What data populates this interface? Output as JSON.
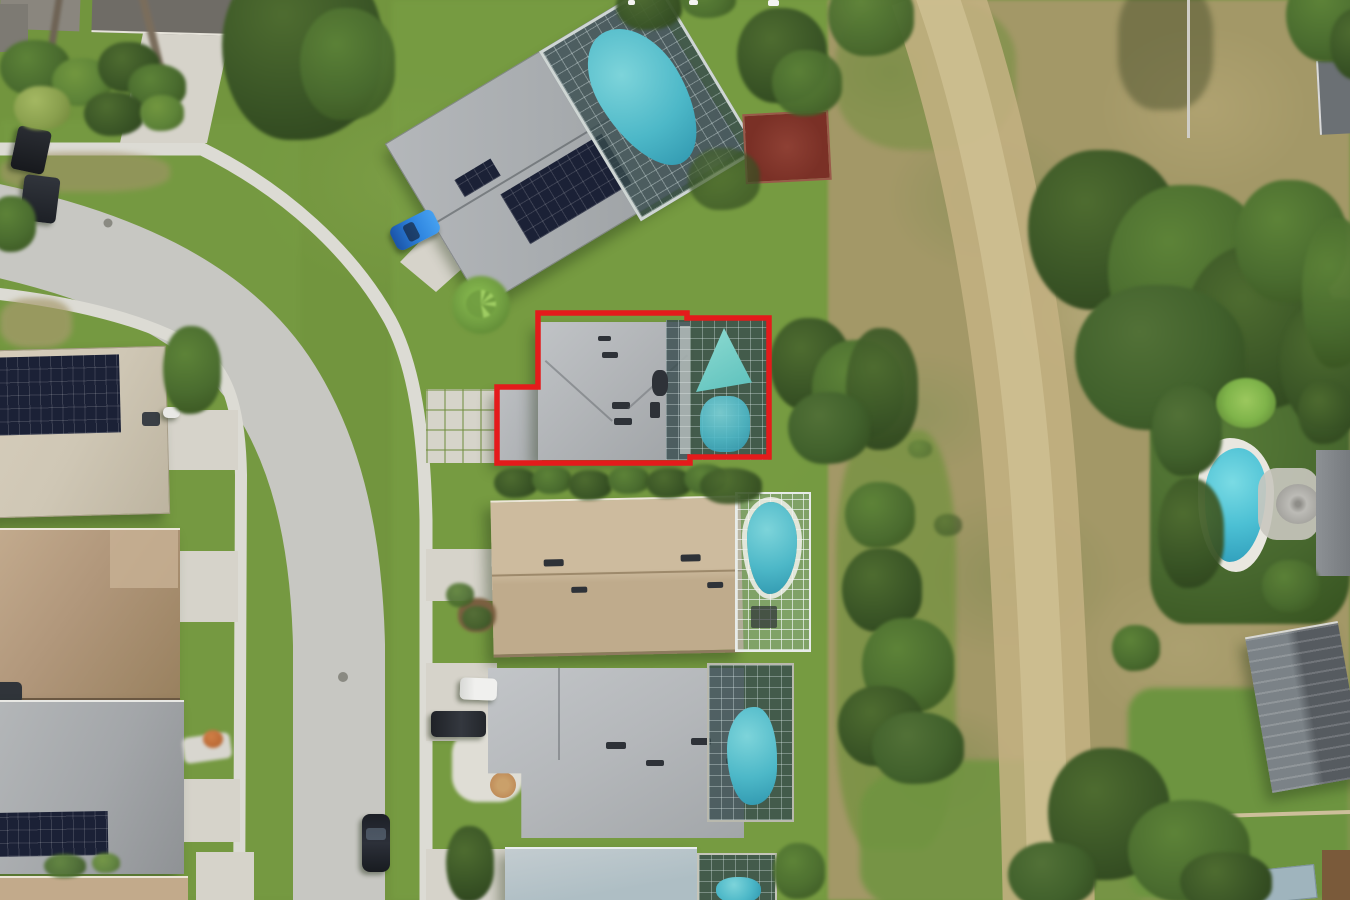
{
  "meta": {
    "description": "Aerial drone photograph of a suburban neighborhood; subject lot highlighted",
    "orientation": "overhead"
  },
  "annotation": {
    "type": "subject-property-boundary",
    "shape": "polygon",
    "color": "#e41b1b",
    "top_edge_text_fragments": {
      "visible": true,
      "legible": false
    }
  },
  "palette": {
    "grass": "#72953e",
    "dry_field": "#a39867",
    "road": "#c7c7c2",
    "sidewalk": "#dcdbd4",
    "driveway": "#d6d3ca",
    "dirt_path": "#c4b183",
    "dirt_path_core": "#d0c094",
    "pool_teal": "#4db8c8",
    "roof_gray": "#b2b5b8",
    "roof_tan": "#c6b295",
    "roof_dark": "#565b60",
    "solar_panel": "#1b2136",
    "tree_green": "#48662e",
    "manhole": "#8a8a82"
  },
  "scene": {
    "subject_lot": {
      "outlined": true,
      "pool_enclosure": true,
      "roof": "gray shingle"
    },
    "counts": {
      "visible_pools": 5,
      "visible_houses": 11,
      "visible_cars": 7,
      "major_tree_clusters": 9
    },
    "features": [
      "curved residential street",
      "sidewalks both sides",
      "solar panel roofs",
      "screened pool enclosures",
      "dry field with dirt path",
      "backyard pool with umbrella",
      "red-brown sport pad",
      "power line"
    ]
  }
}
